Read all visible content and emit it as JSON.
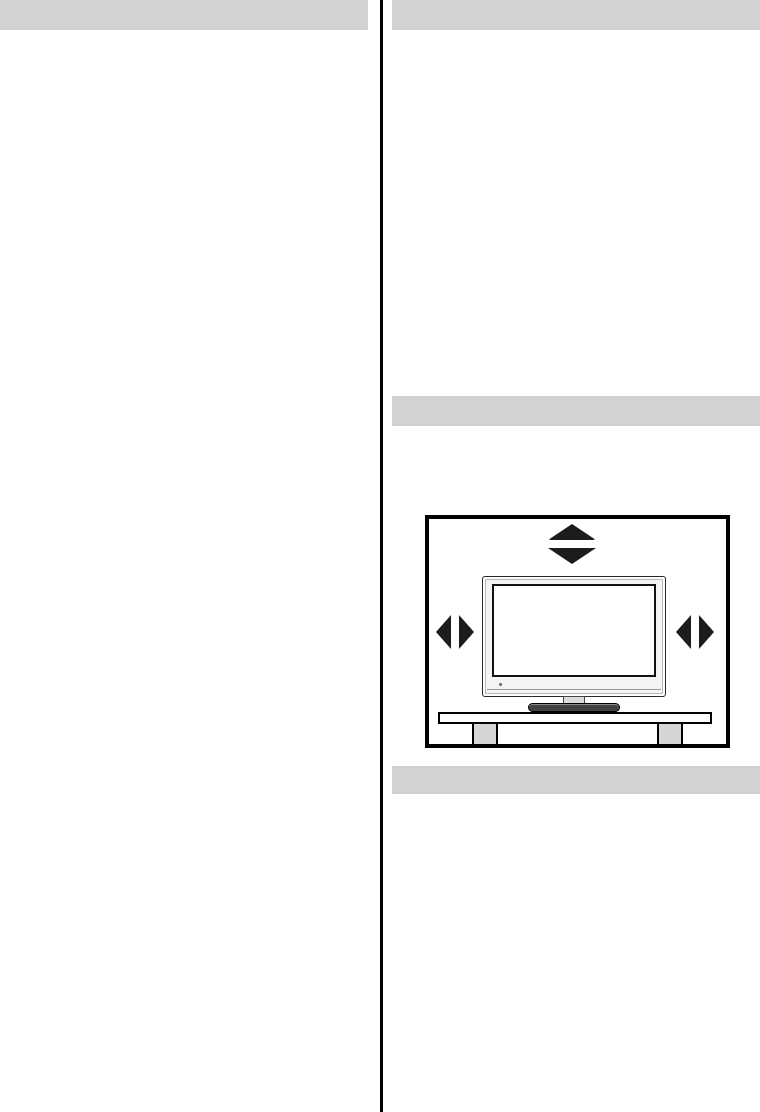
{
  "page": {
    "kind": "scanned manual page",
    "columns": 2,
    "width_px": 760,
    "height_px": 1112
  },
  "colors": {
    "background": "#ffffff",
    "section_bar": "#d2d2d2",
    "divider": "#000000",
    "figure_border": "#000000",
    "arrow": "#1c1c1c",
    "tv_bezel": "#f4f4f4",
    "tv_outline": "#2a2a2a",
    "screen": "#ffffff",
    "screen_border": "#111111",
    "stand_base": "#424242",
    "stand_neck": "#dcdcdc",
    "table_fill": "#ffffff",
    "leg_fill": "#d6d6d6"
  },
  "sections": {
    "left_header_bar": {
      "text": ""
    },
    "right_header_bar": {
      "text": ""
    },
    "right_mid_bar": {
      "text": ""
    },
    "right_bottom_bar": {
      "text": ""
    }
  },
  "figure": {
    "name": "tv-ventilation-clearance-diagram",
    "description_icons": [
      "arrow-up-icon",
      "arrow-down-icon",
      "arrow-left-icon",
      "arrow-right-icon"
    ]
  }
}
